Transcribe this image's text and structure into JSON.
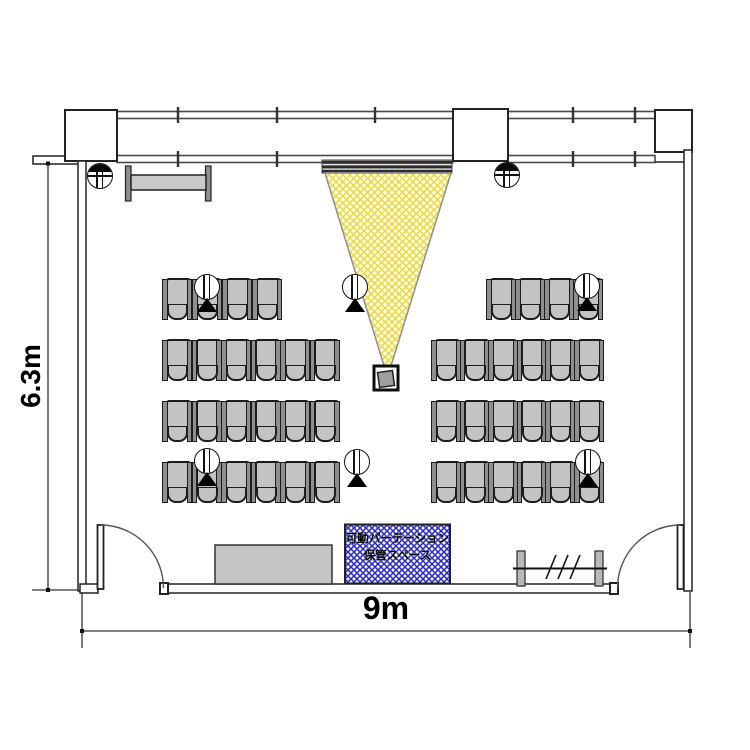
{
  "diagram": {
    "type": "room-floor-plan",
    "dimension_labels": {
      "width": "9m",
      "height": "6.3m"
    },
    "partition_storage_label": {
      "line1": "可動パーテーション",
      "line2": "保管スペース"
    }
  },
  "seating": {
    "total_chairs": 44,
    "rows": 4,
    "blocks": [
      {
        "row": 1,
        "x": 163,
        "y": 278,
        "count": 4,
        "pitch": 30
      },
      {
        "row": 1,
        "x": 487,
        "y": 278,
        "count": 4,
        "pitch": 29
      },
      {
        "row": 2,
        "x": 163,
        "y": 339,
        "count": 6,
        "pitch": 29.5
      },
      {
        "row": 2,
        "x": 432,
        "y": 339,
        "count": 6,
        "pitch": 28.6
      },
      {
        "row": 3,
        "x": 163,
        "y": 400,
        "count": 6,
        "pitch": 29.5
      },
      {
        "row": 3,
        "x": 432,
        "y": 400,
        "count": 6,
        "pitch": 28.6
      },
      {
        "row": 4,
        "x": 163,
        "y": 461,
        "count": 6,
        "pitch": 29.5
      },
      {
        "row": 4,
        "x": 432,
        "y": 461,
        "count": 6,
        "pitch": 28.6
      }
    ]
  },
  "devices": {
    "tripods": [
      {
        "x": 207,
        "y": 287
      },
      {
        "x": 355,
        "y": 287
      },
      {
        "x": 587,
        "y": 286
      },
      {
        "x": 207,
        "y": 461
      },
      {
        "x": 357,
        "y": 462
      },
      {
        "x": 588,
        "y": 462
      }
    ],
    "wall_fixtures": [
      {
        "x": 100,
        "y": 176
      },
      {
        "x": 507,
        "y": 175
      }
    ]
  },
  "colors": {
    "wall_line": "#222222",
    "beam_fill": "#ffffd8",
    "beam_hatch": "#ecd44a",
    "partition_fill": "#f2f3ff",
    "partition_hatch": "#2b2bb8",
    "chair": "#c3c3c3",
    "cabinet": "#c4c4c4"
  }
}
